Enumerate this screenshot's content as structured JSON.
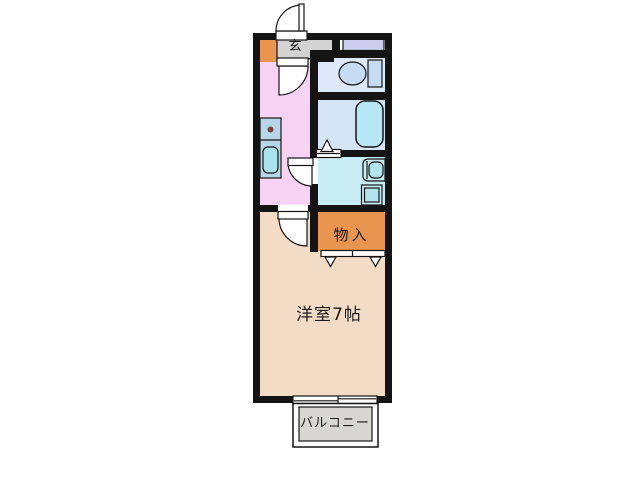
{
  "plan": {
    "type": "apartment-floor-plan",
    "rooms": {
      "genkan": {
        "label": "玄"
      },
      "storage": {
        "label": "物入"
      },
      "main_room": {
        "label": "洋室7帖"
      },
      "balcony": {
        "label": "バルコニー"
      }
    },
    "fixtures": [
      "entrance-door",
      "toilet",
      "bathtub",
      "vanity-sink",
      "washing-machine",
      "kitchen-counter",
      "kitchen-sink",
      "stove",
      "folding-doors",
      "sliding-window"
    ]
  },
  "colors": {
    "background": "#ffffff",
    "wall": "#141414",
    "genkan_gray": "#d3d3d3",
    "storage_orange": "#e9954f",
    "lavender": "#ccccef",
    "toilet_room": "#dde9fa",
    "toilet_fixture": "#c6dbf4",
    "bathroom": "#d5e5f6",
    "bathtub": "#b7e6f4",
    "washroom": "#c9edf4",
    "fixture_cyan": "#b2e4ee",
    "kitchen_pink": "#f8d2f2",
    "counter_blue": "#b7d6ea",
    "sink_cyan": "#a8e2ea",
    "stove_dot": "#7a4545",
    "main_room_beige": "#f3dcc6",
    "balcony_gray": "#d7d6d1"
  }
}
